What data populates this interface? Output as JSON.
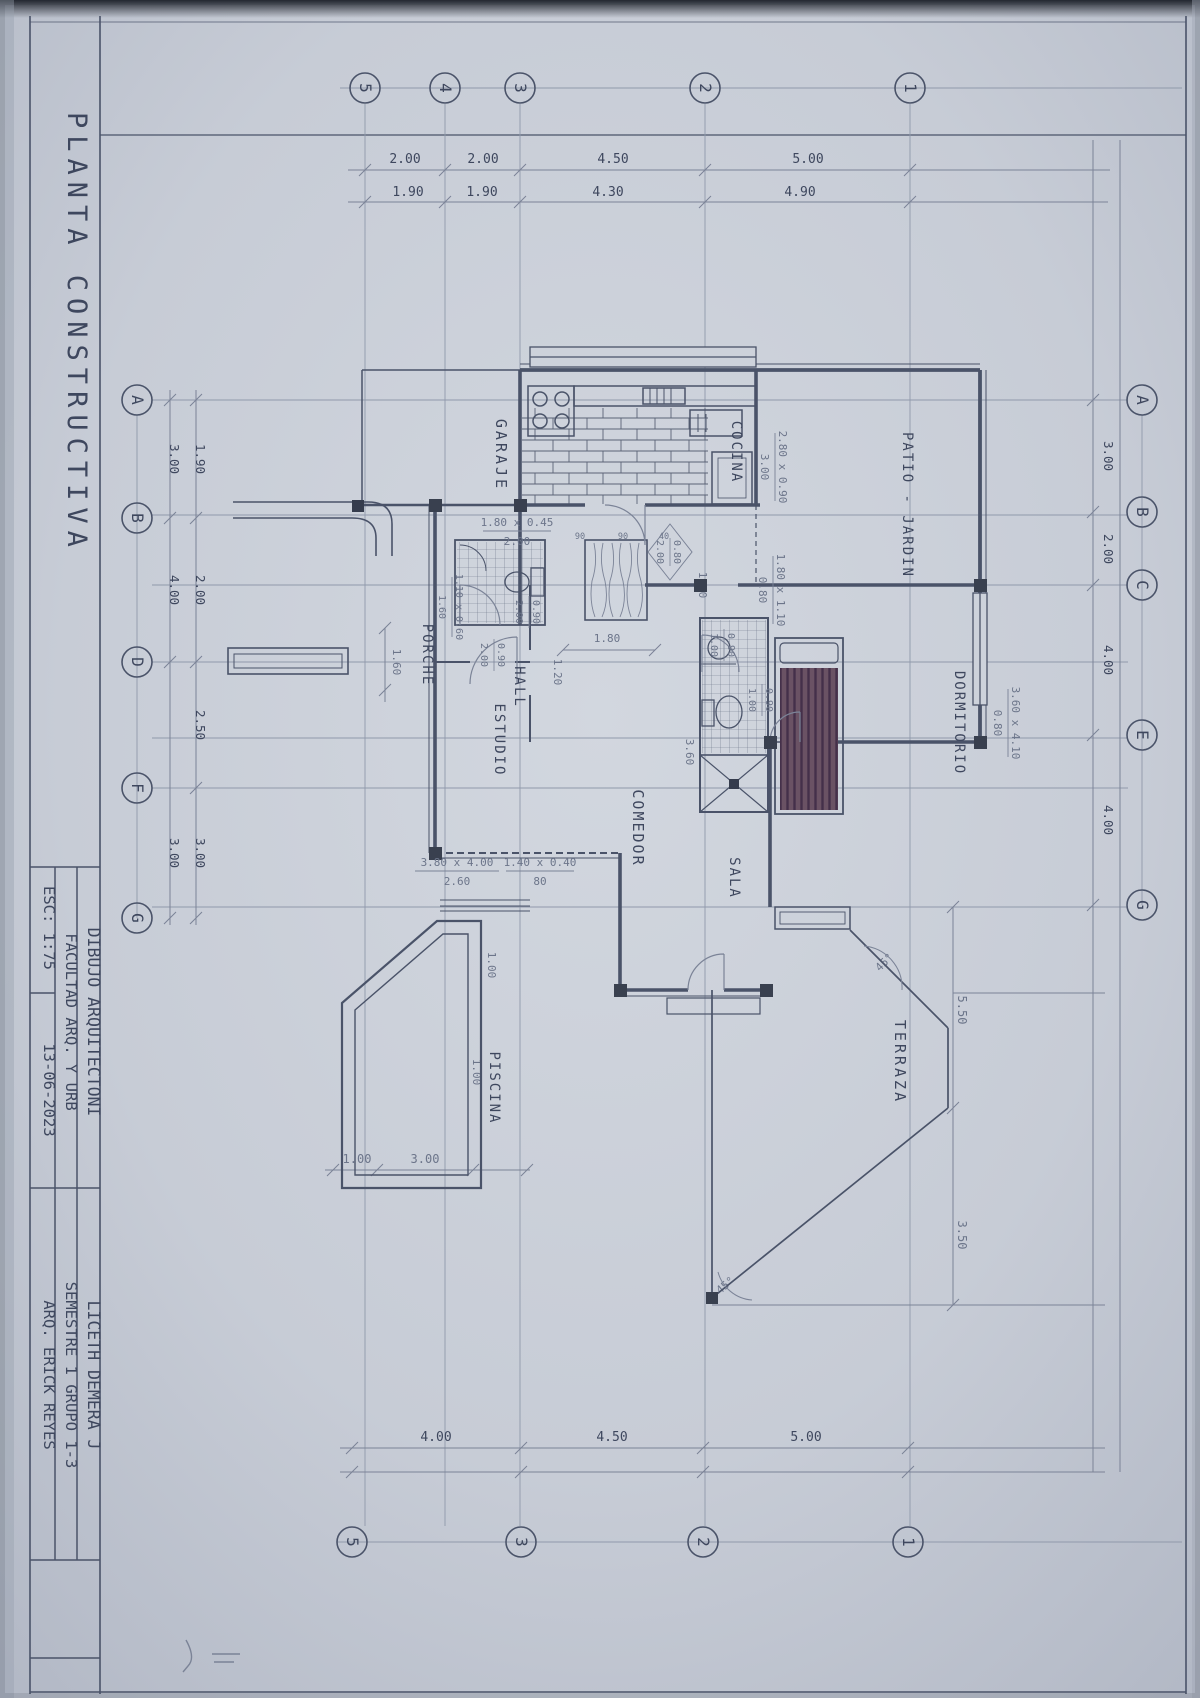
{
  "colors": {
    "paper": "#c7ccd6",
    "paper_light": "#d2d7df",
    "paper_dark": "#b3b9c6",
    "ink": "#4a5369",
    "pencil": "#7b8397",
    "appliance_dark": "#353c4d",
    "bed_fill": "#6a5264"
  },
  "sheet": {
    "title": "PLANTA CONSTRUCTIVA"
  },
  "title_block": {
    "project_label": "DIBUJO ARQUITECTONI",
    "project_value": "LICETH DEMERA J",
    "faculty_label": "FACULTAD ARQ. Y URB",
    "faculty_value": "SEMESTRE 1 GRUPO 1-3",
    "scale": "ESC: 1:75",
    "date": "13-06-2023",
    "professor": "ARQ. ERICK REYES"
  },
  "grid": {
    "top": [
      "5",
      "4",
      "3",
      "2",
      "1"
    ],
    "bottom": [
      "5",
      "3",
      "2",
      "1"
    ],
    "left": [
      "A",
      "B",
      "D",
      "F",
      "G"
    ],
    "right": [
      "A",
      "B",
      "C",
      "E",
      "G"
    ]
  },
  "dims": {
    "top_row1": [
      "2.00",
      "2.00",
      "4.50",
      "5.00"
    ],
    "top_row2": [
      "1.90",
      "1.90",
      "4.30",
      "4.90"
    ],
    "bottom": [
      "4.00",
      "4.50",
      "5.00"
    ],
    "left_inner": [
      "1.90",
      "2.00",
      "2.50",
      "3.00"
    ],
    "left_outer": [
      "3.00",
      "4.00",
      "3.00"
    ],
    "right": [
      "3.00",
      "2.00",
      "4.00",
      "4.00"
    ],
    "terraza": [
      "5.50",
      "3.50"
    ],
    "pool_bottom": [
      "1.00",
      "3.00"
    ],
    "pool_side": [
      "1.00",
      "1.00"
    ],
    "interior": [
      "1.80",
      "1.60",
      "3.60",
      "1.20",
      "1.60"
    ],
    "angles": [
      "45°",
      "45°"
    ]
  },
  "rooms": {
    "garaje": "GARAJE",
    "cocina": "COCINA",
    "patio": "PATIO - JARDIN",
    "porche": "PORCHE",
    "hall": "HALL",
    "estudio": "ESTUDIO",
    "comedor": "COMEDOR",
    "sala": "SALA",
    "dormitorio": "DORMITORIO",
    "terraza": "TERRAZA",
    "piscina": "PISCINA"
  },
  "window_notes": [
    {
      "size": "1.80 x 0.45",
      "sill": "2.00"
    },
    {
      "size": "2.80 x 0.90",
      "sill": "3.00"
    },
    {
      "size": "1.80 x 1.10",
      "sill": "0.80"
    },
    {
      "size": "3.60 x 4.10",
      "sill": "0.80"
    },
    {
      "size": "1.10 x 0.60",
      "sill": "1.60"
    },
    {
      "size": "3.80 x 4.00",
      "sill": "2.60"
    },
    {
      "size": "1.40 x 0.40",
      "sill": "80"
    }
  ],
  "door_notes": [
    {
      "w": "0.90",
      "h": "2.00"
    },
    {
      "w": "0.90",
      "h": "2.00"
    },
    {
      "w": "0.80",
      "h": "2.00"
    },
    {
      "w": "0.90",
      "h": "1.00"
    },
    {
      "w": "0.90",
      "h": "1.00"
    }
  ],
  "counter_marks": [
    "90",
    "90",
    "40"
  ]
}
